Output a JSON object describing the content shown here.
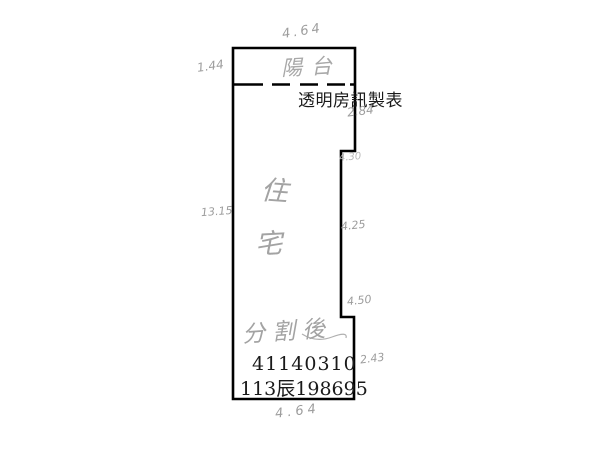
{
  "page": {
    "background_color": "#ffffff",
    "description_labels": {
      "watermark": "透明房訊製表"
    }
  },
  "plan": {
    "balcony_label": "陽台",
    "unit_label_chars": [
      "住",
      "宅"
    ],
    "note": "分割後",
    "parcel_number": "41140310",
    "registration_number": "113辰198695",
    "dimensions": {
      "top": "4.64",
      "left_top": "1.44",
      "left_mid": "13.15",
      "right_1": "2.84",
      "right_2": "4.30",
      "right_3": "4.25",
      "right_4": "4.50",
      "right_5": "2.43",
      "bottom": "4.64"
    },
    "colors": {
      "outline": "#000000",
      "handwriting": "#9d9d9d",
      "printed_text": "#1a1a1a"
    }
  }
}
